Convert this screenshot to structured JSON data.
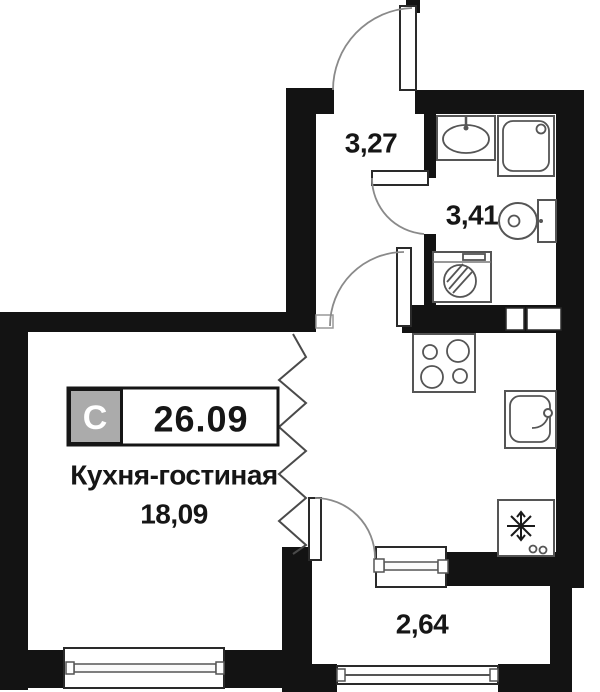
{
  "plan": {
    "badge": {
      "type_label": "С",
      "total_area": "26.09"
    },
    "rooms": {
      "kitchen_living": {
        "name": "Кухня-гостиная",
        "area": "18,09"
      },
      "hallway": {
        "area": "3,27"
      },
      "bathroom": {
        "area": "3,41"
      },
      "balcony": {
        "area": "2,64"
      }
    },
    "fixtures": [
      "entrance-door",
      "interior-door",
      "bathroom-door",
      "balcony-door",
      "bathroom-sink",
      "shower-cabin",
      "toilet",
      "washing-machine",
      "ventilation-shaft",
      "cooktop",
      "kitchen-sink",
      "refrigerator",
      "window"
    ],
    "colors": {
      "wall": "#131313",
      "badge_gray": "#ababab",
      "fixture_line": "#555555",
      "door_arc": "#8a8a8a",
      "background": "#ffffff"
    }
  }
}
